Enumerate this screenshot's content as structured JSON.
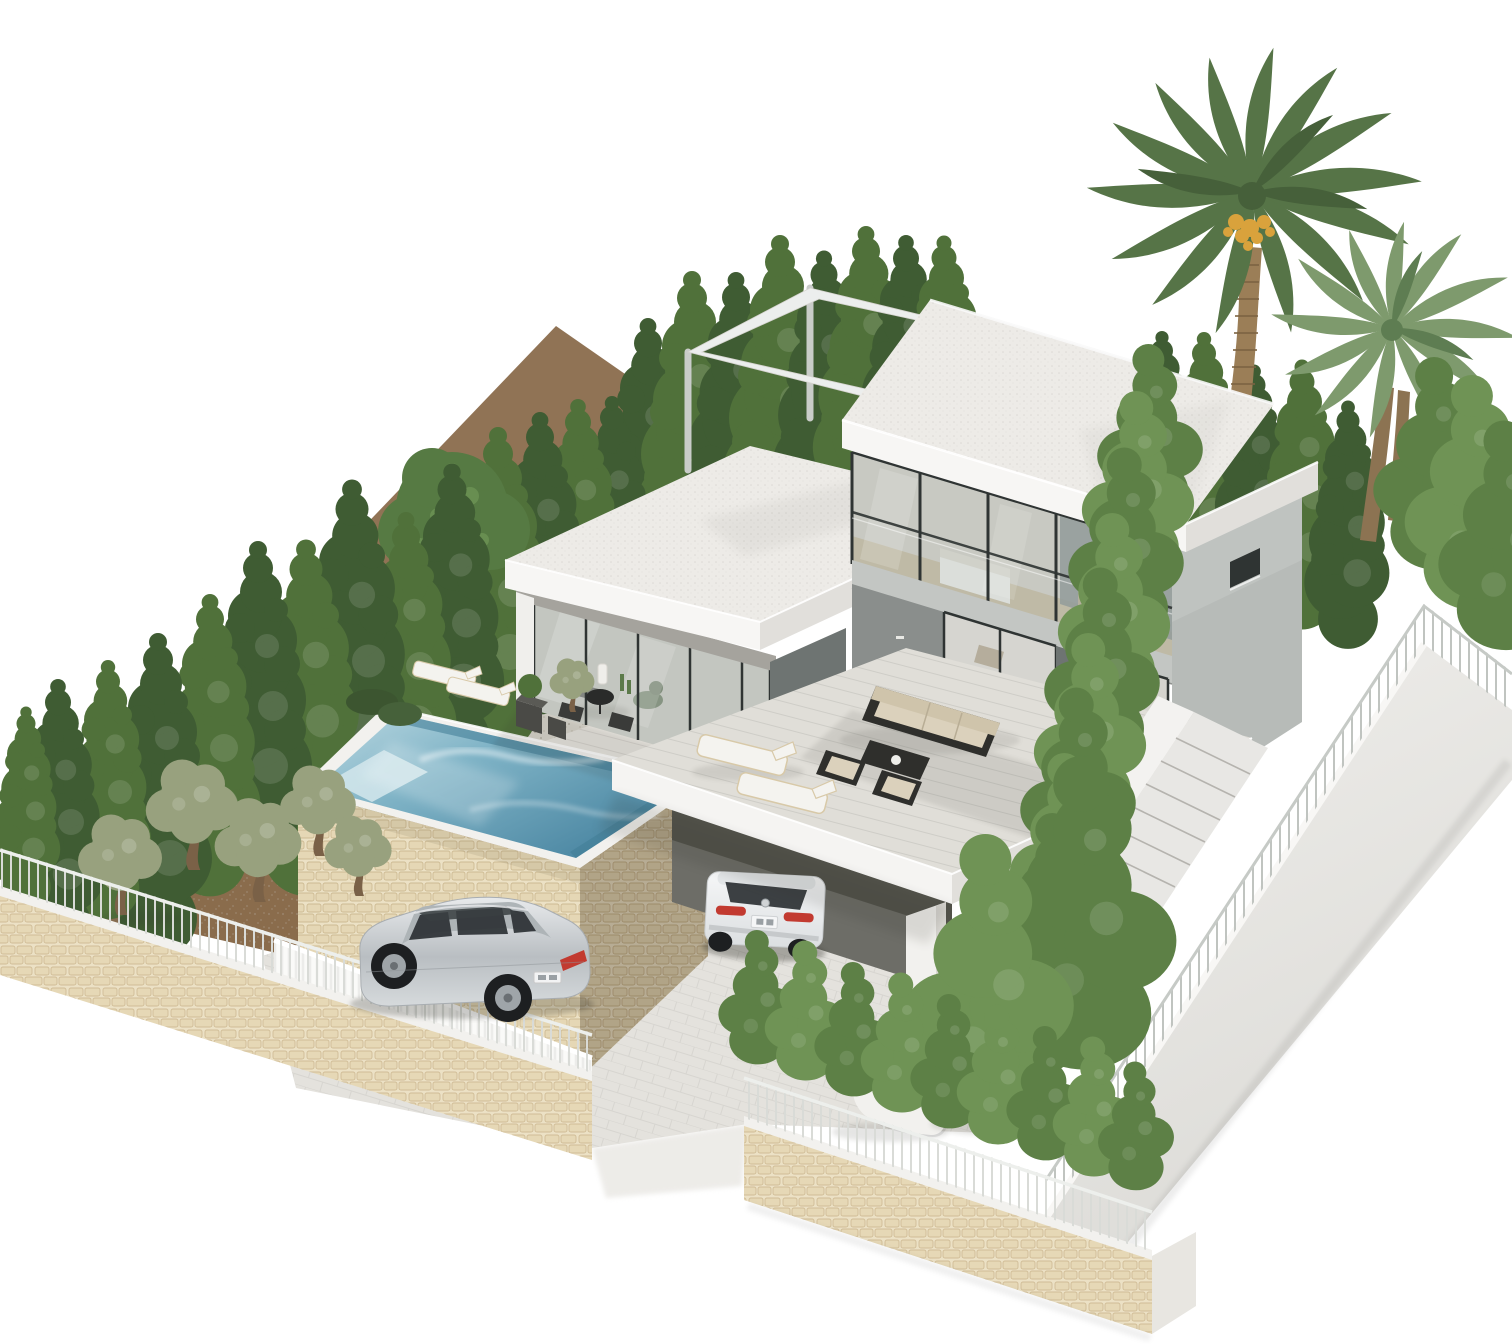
{
  "scene": {
    "title": "3D architectural rendering of a modern two-storey villa with raised stone pool, carport, olive grove, cypress hedges and date palms on a white background",
    "objects": [
      "two-storey flat-roof villa with cutaway glass facade",
      "rooftop pergola frame",
      "single-storey glazed living wing",
      "raised infinity pool on natural stone wall",
      "stone perimeter walls with white railings",
      "white slat gate wall",
      "olive grove on earth terrace",
      "italian cypress tree rows",
      "fluffy cypress hedge along retaining wall",
      "two date palm trees",
      "silver estate car on driveway",
      "white SUV parked under carport",
      "external staircase with curved wall",
      "outdoor lounge set and sun loungers",
      "gravel patio with loungers and potted plants"
    ]
  },
  "colors": {
    "background": "#ffffff",
    "roof_top": "#edebe7",
    "roof_fascia": "#f7f6f4",
    "roof_fascia_shade": "#e1dfdb",
    "wall_gray": "#8a8e8c",
    "wall_gray_dark": "#6e7472",
    "wall_light": "#b7bbb8",
    "floor_band": "#c3c6c3",
    "glass_tint": "#adb9ba",
    "glass_frame": "#2f3433",
    "interior_warm": "#d8d2c6",
    "interior_floor": "#c8b694",
    "bed_white": "#f4f2ec",
    "terrace_top": "#e0ded8",
    "terrace_fascia": "#f5f4f2",
    "paving": "#e4e2dd",
    "paving_warm": "#e7e4de",
    "gravel": "#d8d5cc",
    "dirt": "#8a6c4c",
    "dirt_dark": "#6f563c",
    "stone_bg": "#eadfc2",
    "stone_block": "#e2d3ae",
    "stone_joint": "#c4ae83",
    "pool_shallow": "#bcd9e2",
    "pool_mid": "#7fb3c6",
    "pool_deep": "#4f8aa5",
    "pool_coping": "#f2f1ee",
    "cypress_dark": "#3f5c33",
    "cypress_mid": "#50713a",
    "hedge_green": "#5d8046",
    "hedge_light": "#6f9355",
    "olive_green": "#98a17e",
    "olive_trunk": "#7a6147",
    "palm_green": "#567447",
    "palm_light": "#7e9a6d",
    "palm_trunk": "#9b7e57",
    "palm_fruit": "#d9a23c",
    "round_tree": "#567a43",
    "rail_white": "#edefec",
    "rail_gray": "#c6cac6",
    "fence_white": "#fafaf8",
    "retaining_wall": "#e9e8e5",
    "stair_tread": "#e8e7e4",
    "carport_dark": "#6d6d67",
    "car_silver": "#ccd0d3",
    "car_silver_shade": "#a8adb1",
    "car_white": "#eef0f1",
    "taillight": "#c23a30",
    "window_dark": "#2c3134",
    "furn_frame": "#2f2f2c",
    "cushion": "#dbd1bc",
    "lounger_white": "#f4f3ef",
    "lounger_wood": "#d8c9a8",
    "shadow": "#30302b"
  }
}
